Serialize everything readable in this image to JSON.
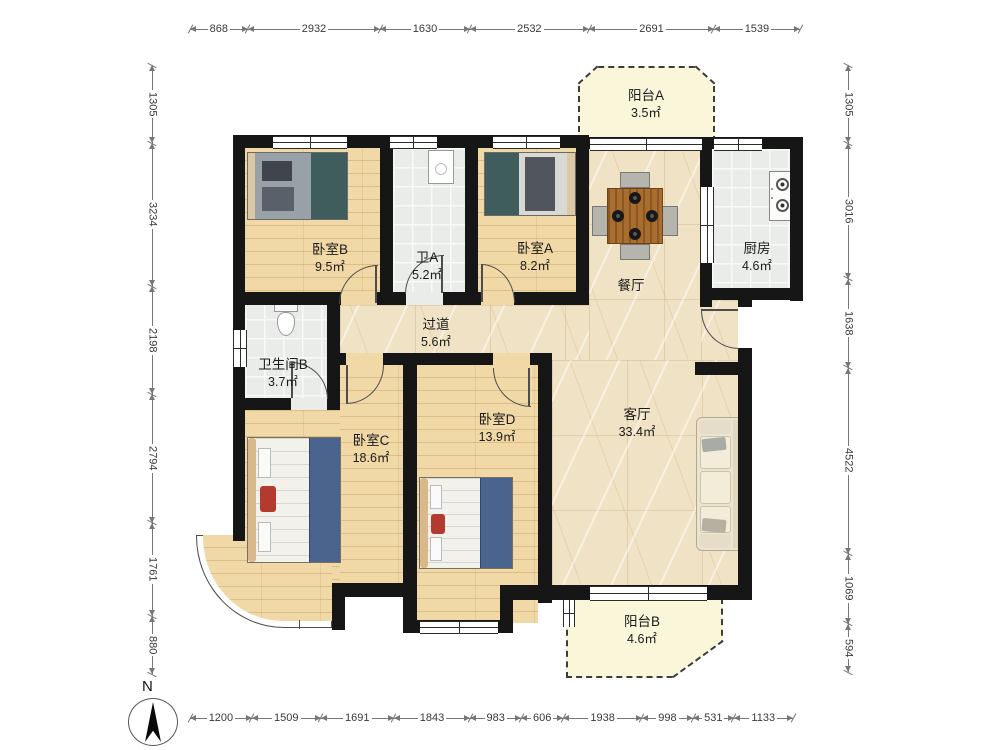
{
  "compass": {
    "north_label": "N"
  },
  "rooms": [
    {
      "id": "balcony-a",
      "name": "阳台A",
      "area": "3.5㎡"
    },
    {
      "id": "kitchen",
      "name": "厨房",
      "area": "4.6㎡"
    },
    {
      "id": "bedroom-b",
      "name": "卧室B",
      "area": "9.5㎡"
    },
    {
      "id": "bath-a",
      "name": "卫A",
      "area": "5.2㎡"
    },
    {
      "id": "bedroom-a",
      "name": "卧室A",
      "area": "8.2㎡"
    },
    {
      "id": "dining",
      "name": "餐厅",
      "area": ""
    },
    {
      "id": "hallway",
      "name": "过道",
      "area": "5.6㎡"
    },
    {
      "id": "bath-b",
      "name": "卫生间B",
      "area": "3.7㎡"
    },
    {
      "id": "living",
      "name": "客厅",
      "area": "33.4㎡"
    },
    {
      "id": "bedroom-c",
      "name": "卧室C",
      "area": "18.6㎡"
    },
    {
      "id": "bedroom-d",
      "name": "卧室D",
      "area": "13.9㎡"
    },
    {
      "id": "balcony-b",
      "name": "阳台B",
      "area": "4.6㎡"
    }
  ],
  "rulers": {
    "top": [
      868,
      2932,
      1630,
      2532,
      2691,
      1539
    ],
    "bottom": [
      1200,
      1509,
      1691,
      1843,
      983,
      606,
      1938,
      998,
      531,
      1133
    ],
    "left": [
      1305,
      3234,
      2198,
      2794,
      1761,
      880
    ],
    "right": [
      1305,
      3016,
      1638,
      4522,
      1069,
      594
    ]
  },
  "colors": {
    "wall": "#161616",
    "wood_floor": "#f1d9a7",
    "tile_floor": "#e9ece9",
    "marble_floor": "#f0e2c4",
    "balcony_floor": "#f9f6da",
    "bed_blue": "#4a648e",
    "bed_teal": "#3f5d5c",
    "accent_red": "#b23a2e",
    "table_wood": "#a96d2f",
    "sofa_cream": "#ece4d0"
  }
}
